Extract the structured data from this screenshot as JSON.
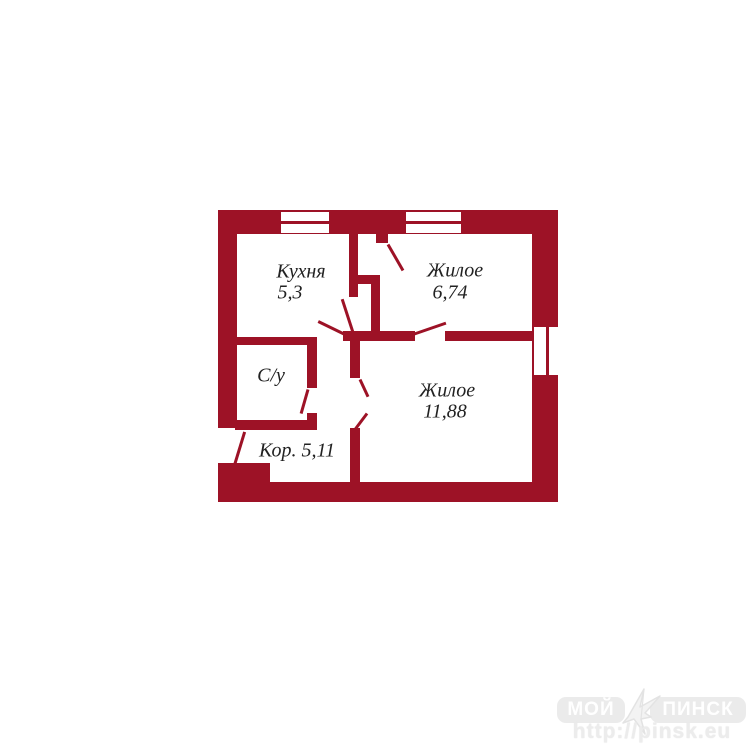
{
  "page": {
    "background": "#ffffff"
  },
  "plan": {
    "wall_color": "#9d1226",
    "label_color": "#222222",
    "rooms": {
      "kitchen": {
        "name": "Кухня",
        "area": "5,3"
      },
      "living_small": {
        "name": "Жилое",
        "area": "6,74"
      },
      "bathroom": {
        "name": "С/у"
      },
      "living_large": {
        "name": "Жилое",
        "area": "11,88"
      },
      "corridor": {
        "name": "Кор.",
        "area": "5,11"
      }
    }
  },
  "watermark": {
    "brand_left": "МОЙ",
    "brand_right": "ПИНСК",
    "url": "http://pinsk.eu",
    "badge_color": "#ebebeb",
    "text_color": "#ffffff",
    "logo": "bird-icon"
  }
}
